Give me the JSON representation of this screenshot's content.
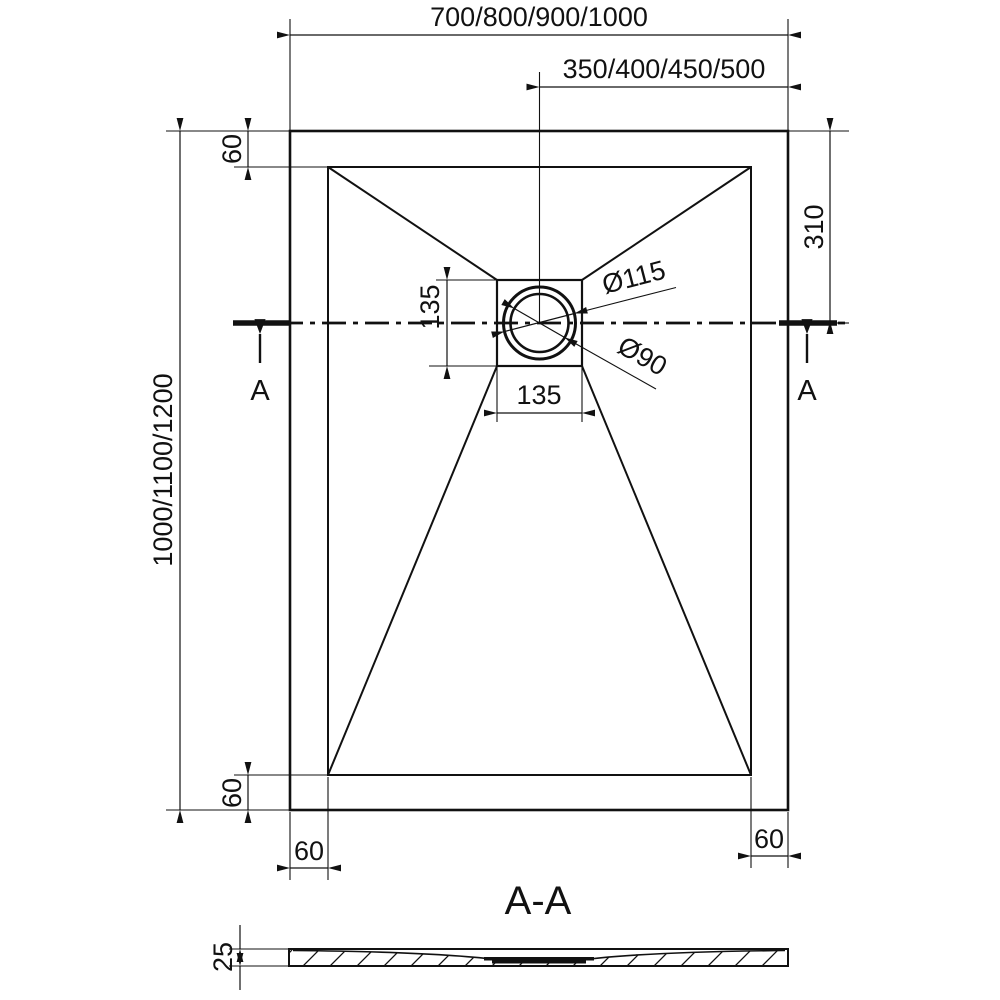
{
  "page": {
    "background": "#ffffff",
    "line_color": "#111111",
    "description": "Technical dimension drawing of a rectangular shower tray, plan view with drain and cross-section A-A"
  },
  "plan_view": {
    "dims": {
      "overall_width": "700/800/900/1000",
      "drain_center_from_right": "350/400/450/500",
      "overall_length": "1000/1100/1200",
      "rim_top": "60",
      "drain_center_from_top": "310",
      "drain_box_height": "135",
      "drain_box_width": "135",
      "drain_outer_diameter": "Ø115",
      "drain_inner_diameter": "Ø90",
      "rim_bottom": "60",
      "rim_bottom_left": "60",
      "rim_bottom_right": "60"
    },
    "section_markers": {
      "left": "A",
      "right": "A"
    }
  },
  "section_view": {
    "title": "A-A",
    "dims": {
      "thickness": "25"
    }
  }
}
